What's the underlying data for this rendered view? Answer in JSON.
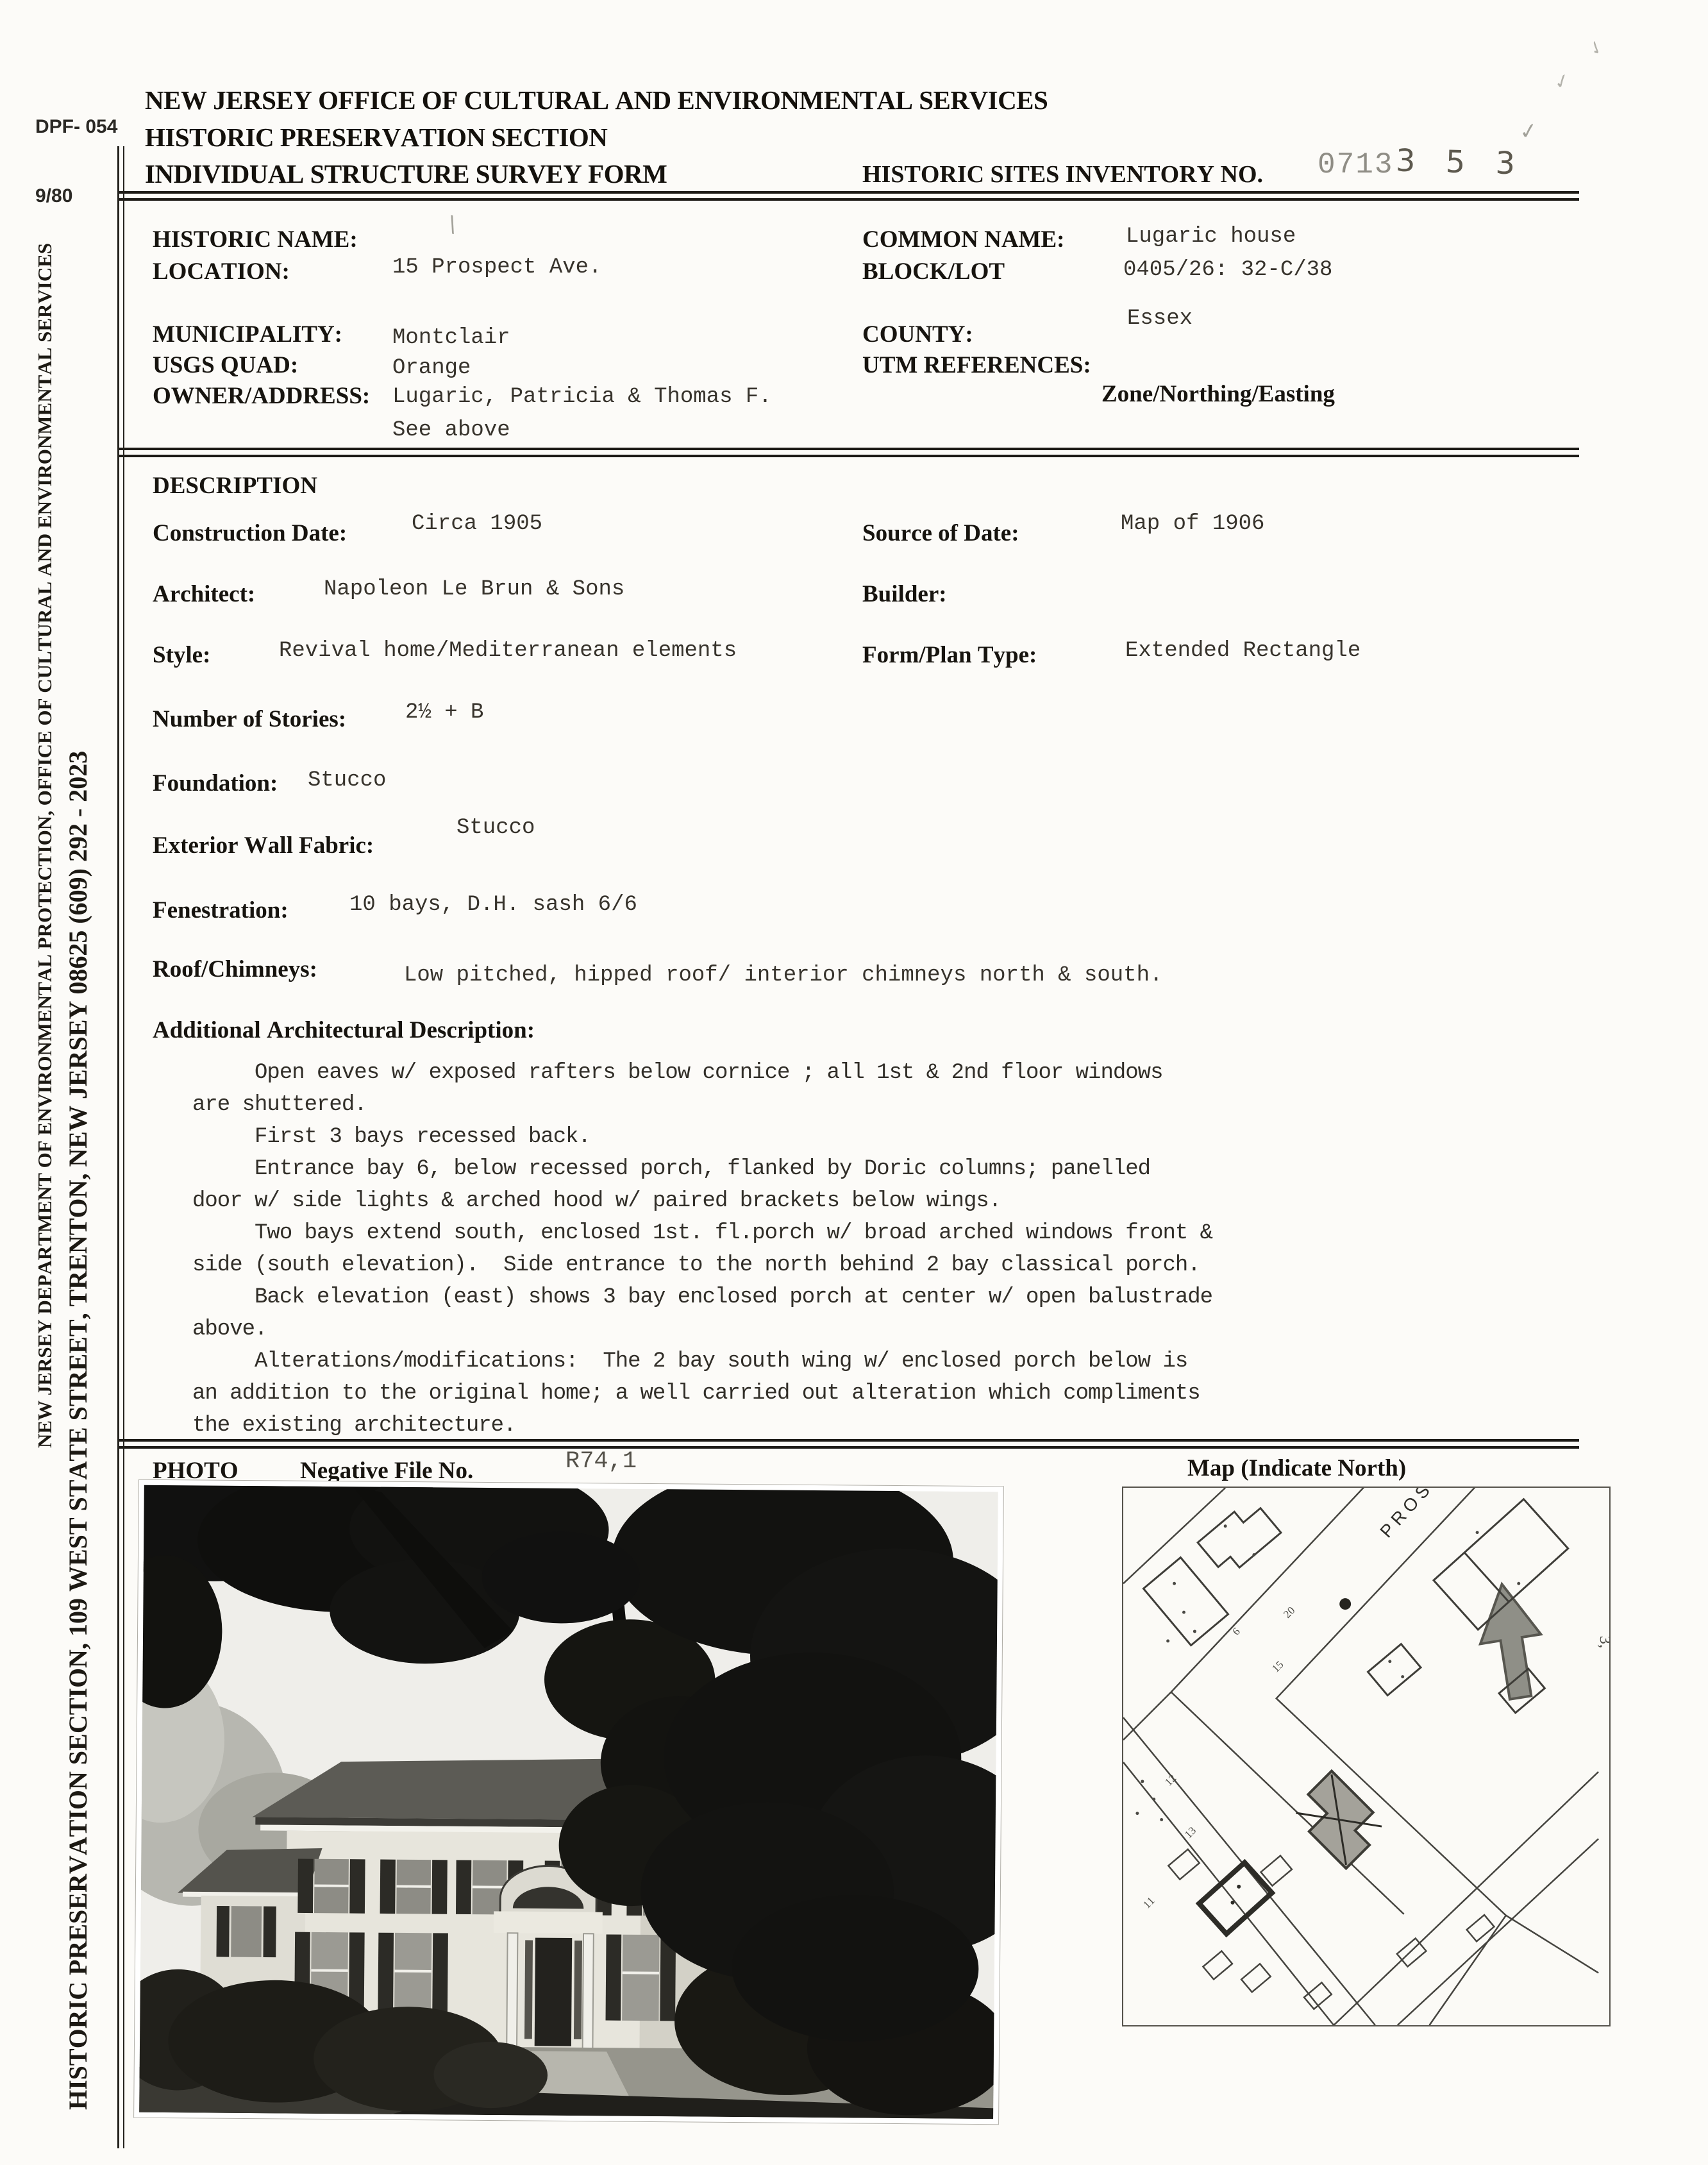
{
  "form_meta": {
    "form_no": "DPF- 054",
    "form_date": "9/80"
  },
  "header": {
    "line1": "NEW JERSEY OFFICE OF CULTURAL AND ENVIRONMENTAL SERVICES",
    "line2": "HISTORIC PRESERVATION SECTION",
    "line3": "INDIVIDUAL STRUCTURE SURVEY FORM",
    "inventory_label": "HISTORIC SITES INVENTORY NO.",
    "inventory_prefix": "0713",
    "inventory_digits": "3 5 3"
  },
  "sidebar": {
    "line1": "NEW JERSEY DEPARTMENT OF ENVIRONMENTAL PROTECTION, OFFICE OF CULTURAL AND ENVIRONMENTAL SERVICES",
    "line2": "HISTORIC PRESERVATION SECTION, 109 WEST STATE STREET, TRENTON, NEW JERSEY  08625   (609) 292 - 2023"
  },
  "identification": {
    "historic_name": {
      "label": "HISTORIC NAME:",
      "value": ""
    },
    "common_name": {
      "label": "COMMON NAME:",
      "value": "Lugaric house"
    },
    "location": {
      "label": "LOCATION:",
      "value": "15 Prospect Ave."
    },
    "block_lot": {
      "label": "BLOCK/LOT",
      "value": "0405/26:  32-C/38"
    },
    "municipality": {
      "label": "MUNICIPALITY:",
      "value": "Montclair"
    },
    "county": {
      "label": "COUNTY:",
      "value": "Essex"
    },
    "usgs_quad": {
      "label": "USGS QUAD:",
      "value": "Orange"
    },
    "utm": {
      "label": "UTM REFERENCES:",
      "value": ""
    },
    "owner": {
      "label": "OWNER/ADDRESS:",
      "value": "Lugaric, Patricia & Thomas F.",
      "value2": "See above"
    },
    "zone": {
      "label": "Zone/Northing/Easting"
    }
  },
  "description": {
    "section_title": "DESCRIPTION",
    "construction_date": {
      "label": "Construction Date:",
      "value": "Circa 1905"
    },
    "source_of_date": {
      "label": "Source of Date:",
      "value": "Map of 1906"
    },
    "architect": {
      "label": "Architect:",
      "value": "Napoleon Le Brun & Sons"
    },
    "builder": {
      "label": "Builder:",
      "value": ""
    },
    "style": {
      "label": "Style:",
      "value": "Revival home/Mediterranean elements"
    },
    "form_plan": {
      "label": "Form/Plan Type:",
      "value": "Extended Rectangle"
    },
    "stories": {
      "label": "Number of Stories:",
      "value": "2½ + B"
    },
    "foundation": {
      "label": "Foundation:",
      "value": "Stucco"
    },
    "wall_fabric": {
      "label": "Exterior Wall Fabric:",
      "value": "Stucco"
    },
    "fenestration": {
      "label": "Fenestration:",
      "value": "10 bays, D.H. sash 6/6"
    },
    "roof": {
      "label": "Roof/Chimneys:",
      "value": "Low pitched, hipped roof/ interior chimneys north & south."
    },
    "additional_label": "Additional Architectural Description:",
    "additional_text": "     Open eaves w/ exposed rafters below cornice ; all 1st & 2nd floor windows\nare shuttered.\n     First 3 bays recessed back.\n     Entrance bay 6, below recessed porch, flanked by Doric columns; panelled\ndoor w/ side lights & arched hood w/ paired brackets below wings.\n     Two bays extend south, enclosed 1st. fl.porch w/ broad arched windows front &\nside (south elevation).  Side entrance to the north behind 2 bay classical porch.\n     Back elevation (east) shows 3 bay enclosed porch at center w/ open balustrade\nabove.\n     Alterations/modifications:  The 2 bay south wing w/ enclosed porch below is\nan addition to the original home; a well carried out alteration which compliments\nthe existing architecture."
  },
  "photo_section": {
    "photo_label": "PHOTO",
    "negative_label": "Negative File No.",
    "negative_no": "R74,1",
    "map_label": "Map (Indicate North)"
  },
  "map": {
    "street": "PROSPECT",
    "nums": {
      "n20": "20",
      "n15": "15",
      "n6": "6",
      "n13": "13",
      "n12": "12",
      "n11": "11",
      "n3": "3,"
    }
  },
  "marks": {
    "check": "✓",
    "slash": "\\"
  }
}
